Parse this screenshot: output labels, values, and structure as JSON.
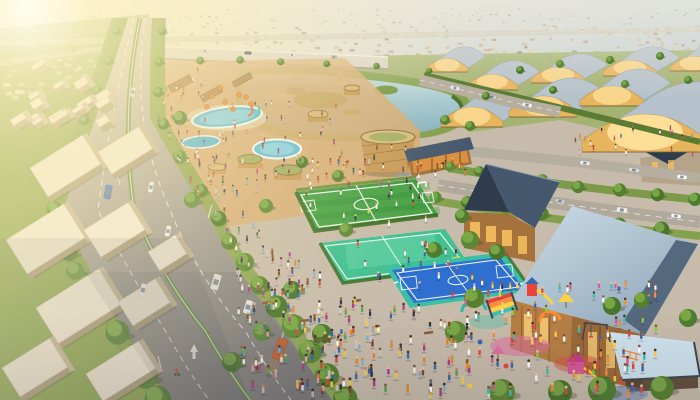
{
  "meta": {
    "description": "Sunset aerial 3D render of a planned community: tree-lined boulevard with traffic, lake with reed islands under an elevated highway, rows of golden arched-roof pavilion halls, suburban sprawl to the horizon, a park with swimming pools and round timber pavilions, a green soccer field, teal multi-sport court, blue basketball court, timber buildings with slate roofs, and a colorful crowded playground."
  },
  "palette": {
    "pavement": "#c7bcab",
    "parkTan": "#d7ac72",
    "lawnLeft": "#87a24c",
    "grassRight": "#9eb266",
    "bank": "#82a04e",
    "hedge": "#54762f",
    "fieldGreen": "#3e9a3f",
    "fieldLight": "#54ab50",
    "courtTeal": "#41c091",
    "courtTealLight": "#63d2a9",
    "courtBlue": "#2f6fd0",
    "courtBorder": "#3bbfa3",
    "line": "#ffffff",
    "roofSlate": "#46586d",
    "gableDark": "#2e3c4e",
    "roofSteelDark": "#54687e",
    "wood": "#a5713c",
    "woodLight": "#c79a58",
    "woodDark": "#6f4a24",
    "gold": "#e7b55e",
    "goldGlow": "#ffe29b",
    "poolBlue": "#62bcd9",
    "bridgeDeck": "#d8d4c8",
    "roadRight": "#b4ac9e"
  },
  "scene": {
    "suburbs": [
      {
        "x0": 0,
        "x1": 700,
        "y0": 8,
        "y1": 56,
        "n": 420,
        "s0": 1.5,
        "s1": 3.5,
        "pal": "base"
      },
      {
        "x0": 420,
        "x1": 700,
        "y0": 56,
        "y1": 100,
        "n": 150,
        "s0": 2.5,
        "s1": 5,
        "pal": "base"
      },
      {
        "x0": 0,
        "x1": 110,
        "y0": 56,
        "y1": 96,
        "n": 30,
        "s0": 3,
        "s1": 5,
        "pal": "light"
      }
    ],
    "suburbPalettes": {
      "base": [
        "#dcc9a4",
        "#cdb990",
        "#e7d8b8",
        "#c2ad85",
        "#b5a27e",
        "#998a6d"
      ],
      "light": [
        "#efe8d8",
        "#e2d8c2",
        "#d8cdb4"
      ]
    },
    "archedBuildings": [
      [
        447,
        72,
        42,
        13
      ],
      [
        492,
        90,
        52,
        15
      ],
      [
        558,
        83,
        54,
        15
      ],
      [
        630,
        76,
        54,
        15
      ],
      [
        694,
        71,
        48,
        14
      ],
      [
        472,
        127,
        62,
        19
      ],
      [
        543,
        117,
        68,
        20
      ],
      [
        612,
        106,
        64,
        19
      ],
      [
        645,
        152,
        126,
        36
      ]
    ],
    "whiteBlocks": [
      [
        30,
        168,
        62,
        34
      ],
      [
        98,
        152,
        48,
        26
      ],
      [
        6,
        240,
        68,
        40
      ],
      [
        84,
        230,
        52,
        32
      ],
      [
        36,
        308,
        74,
        42
      ],
      [
        118,
        302,
        44,
        28
      ],
      [
        2,
        368,
        56,
        34
      ],
      [
        86,
        374,
        62,
        32
      ],
      [
        148,
        252,
        32,
        22
      ]
    ],
    "smallBlocks": {
      "x0": 2,
      "x1": 96,
      "y0": 58,
      "y1": 140,
      "n": 16,
      "s": 13
    },
    "treeRows": [
      {
        "pts": [
          [
            118,
            30
          ],
          [
            86,
            120
          ],
          [
            54,
            210
          ],
          [
            76,
            272
          ],
          [
            118,
            332
          ],
          [
            158,
            400
          ]
        ],
        "n": 16,
        "r0": 4,
        "r1": 13
      },
      {
        "pts": [
          [
            161,
            32
          ],
          [
            158,
            118
          ],
          [
            212,
            210
          ],
          [
            249,
            272
          ],
          [
            296,
            332
          ],
          [
            344,
            400
          ]
        ],
        "n": 15,
        "r0": 4,
        "r1": 13
      },
      {
        "pts": [
          [
            448,
            166
          ],
          [
            560,
            184
          ],
          [
            696,
            198
          ]
        ],
        "n": 8,
        "r0": 5,
        "r1": 7
      },
      {
        "pts": [
          [
            434,
            196
          ],
          [
            540,
            214
          ],
          [
            660,
            230
          ]
        ],
        "n": 7,
        "r0": 6,
        "r1": 8
      },
      {
        "pts": [
          [
            428,
            70
          ],
          [
            300,
            62
          ],
          [
            200,
            60
          ]
        ],
        "n": 6,
        "r0": 3,
        "r1": 4
      }
    ],
    "trees": [
      [
        180,
        118,
        7
      ],
      [
        192,
        200,
        8
      ],
      [
        266,
        206,
        7
      ],
      [
        302,
        162,
        6
      ],
      [
        338,
        176,
        6
      ],
      [
        346,
        230,
        7
      ],
      [
        292,
        290,
        9
      ],
      [
        322,
        334,
        10
      ],
      [
        262,
        332,
        9
      ],
      [
        232,
        362,
        10
      ],
      [
        434,
        250,
        8
      ],
      [
        462,
        216,
        7
      ],
      [
        470,
        240,
        9
      ],
      [
        497,
        252,
        8
      ],
      [
        474,
        298,
        10
      ],
      [
        456,
        332,
        11
      ],
      [
        502,
        392,
        13
      ],
      [
        560,
        392,
        12
      ],
      [
        612,
        306,
        9
      ],
      [
        602,
        390,
        14
      ],
      [
        662,
        388,
        12
      ],
      [
        688,
        318,
        9
      ],
      [
        642,
        300,
        8
      ],
      [
        470,
        126,
        5
      ],
      [
        445,
        120,
        5
      ],
      [
        486,
        96,
        4
      ],
      [
        553,
        90,
        4
      ],
      [
        625,
        84,
        4
      ],
      [
        688,
        80,
        4
      ],
      [
        520,
        70,
        4
      ],
      [
        560,
        64,
        4
      ],
      [
        610,
        60,
        4
      ],
      [
        660,
        56,
        4
      ]
    ],
    "umbrellas": [
      [
        212,
        96
      ],
      [
        225,
        102
      ],
      [
        239,
        95
      ],
      [
        251,
        104
      ],
      [
        207,
        107
      ],
      [
        233,
        109
      ],
      [
        220,
        88
      ],
      [
        246,
        97
      ]
    ],
    "roadRightEdge": [
      [
        152,
        18
      ],
      [
        150,
        118
      ],
      [
        205,
        210
      ],
      [
        240,
        272
      ],
      [
        286,
        332
      ],
      [
        332,
        400
      ]
    ],
    "carsBack": [
      [
        455,
        88,
        12,
        9,
        4,
        "#eef0f0"
      ],
      [
        492,
        97,
        12,
        9,
        4,
        "#c8ccd0"
      ],
      [
        527,
        105,
        12,
        10,
        4,
        "#f2f2ef"
      ],
      [
        585,
        163,
        8,
        10,
        4,
        "#eceeee"
      ],
      [
        634,
        170,
        8,
        11,
        4,
        "#d8dadb"
      ],
      [
        682,
        177,
        8,
        10,
        4,
        "#ffffff"
      ],
      [
        500,
        192,
        9,
        11,
        5,
        "#f4f4f1"
      ],
      [
        560,
        201,
        9,
        10,
        4,
        "#caccce"
      ],
      [
        622,
        210,
        9,
        11,
        5,
        "#eeeeec"
      ],
      [
        676,
        216,
        9,
        10,
        4,
        "#ffffff"
      ],
      [
        205,
        51,
        2,
        7,
        3,
        "#e8e8e6"
      ],
      [
        248,
        53,
        2,
        7,
        3,
        "#5a6270"
      ],
      [
        292,
        55,
        2,
        7,
        3,
        "#f2f2f0"
      ],
      [
        334,
        57,
        2,
        6,
        3,
        "#c2c6ca"
      ],
      [
        60,
        38,
        -40,
        6,
        3,
        "#e8e8e6"
      ],
      [
        74,
        50,
        -40,
        6,
        3,
        "#aab0b6"
      ]
    ],
    "carsFront": [
      [
        133,
        92,
        -79,
        10,
        5,
        "#dadee0"
      ],
      [
        108,
        192,
        -80,
        14,
        7,
        "#3f6fc9"
      ],
      [
        151,
        187,
        -79,
        11,
        5,
        "#eceff0"
      ],
      [
        168,
        231,
        -77,
        11,
        5,
        "#f0f0ee"
      ],
      [
        143,
        290,
        -76,
        13,
        6,
        "#eef0f2"
      ],
      [
        216,
        282,
        -74,
        16,
        8,
        "#e9e7e1"
      ],
      [
        248,
        307,
        -73,
        14,
        7,
        "#f2f2ef"
      ],
      [
        280,
        349,
        -71,
        22,
        10,
        "#d2622e"
      ]
    ],
    "cyclist": {
      "x": 177,
      "y": 372
    },
    "peoplePalettes": {
      "default": [
        "#d84b3a",
        "#e8842c",
        "#f2d13e",
        "#ffffff",
        "#f4efe6",
        "#3a66b0",
        "#7fb3d8",
        "#2e3a4a",
        "#7a4a2a",
        "#e8a0b4",
        "#57a357",
        "#c9c9c9",
        "#b03a8c"
      ],
      "warm": [
        "#d84b3a",
        "#e8842c",
        "#ffffff",
        "#8a4a2a",
        "#f2d13e"
      ],
      "kids": [
        "#e8443c",
        "#ff8c2e",
        "#ffd23e",
        "#3fbfae",
        "#d8569b",
        "#3a66b0",
        "#ffffff",
        "#7fd23e"
      ],
      "jersey": [
        "#ffffff",
        "#e84c3c",
        "#3a66b0",
        "#f2d13e",
        "#2e3a4a",
        "#ffffff"
      ]
    },
    "crowds": [
      {
        "type": "road",
        "y0": 95,
        "y1": 395,
        "w": 46,
        "n": 85,
        "pal": "default"
      },
      {
        "type": "rect",
        "x": 192,
        "y": 102,
        "w": 150,
        "h": 92,
        "n": 70,
        "pal": "default"
      },
      {
        "type": "rect",
        "x": 232,
        "y": 300,
        "w": 240,
        "h": 95,
        "n": 130,
        "pal": "default"
      },
      {
        "type": "rect",
        "x": 236,
        "y": 252,
        "w": 88,
        "h": 48,
        "n": 28,
        "pal": "default"
      },
      {
        "type": "rect",
        "x": 330,
        "y": 140,
        "w": 88,
        "h": 45,
        "n": 26,
        "pal": "default"
      },
      {
        "type": "rect",
        "x": 413,
        "y": 158,
        "w": 54,
        "h": 18,
        "n": 12,
        "pal": "warm"
      },
      {
        "type": "rect",
        "x": 462,
        "y": 284,
        "w": 195,
        "h": 110,
        "n": 85,
        "pal": "kids"
      },
      {
        "type": "rect",
        "x": 568,
        "y": 128,
        "w": 126,
        "h": 26,
        "n": 20,
        "pal": "default"
      },
      {
        "type": "rect",
        "x": 156,
        "y": 62,
        "w": 56,
        "h": 42,
        "n": 14,
        "pal": "default"
      },
      {
        "type": "rect",
        "x": 306,
        "y": 186,
        "w": 122,
        "h": 38,
        "n": 14,
        "pal": "jersey"
      },
      {
        "type": "rect",
        "x": 332,
        "y": 238,
        "w": 125,
        "h": 40,
        "n": 16,
        "pal": "jersey"
      },
      {
        "type": "rect",
        "x": 398,
        "y": 262,
        "w": 122,
        "h": 36,
        "n": 12,
        "pal": "jersey"
      },
      {
        "type": "rect",
        "x": 586,
        "y": 352,
        "w": 70,
        "h": 30,
        "n": 10,
        "pal": "kids"
      }
    ]
  }
}
